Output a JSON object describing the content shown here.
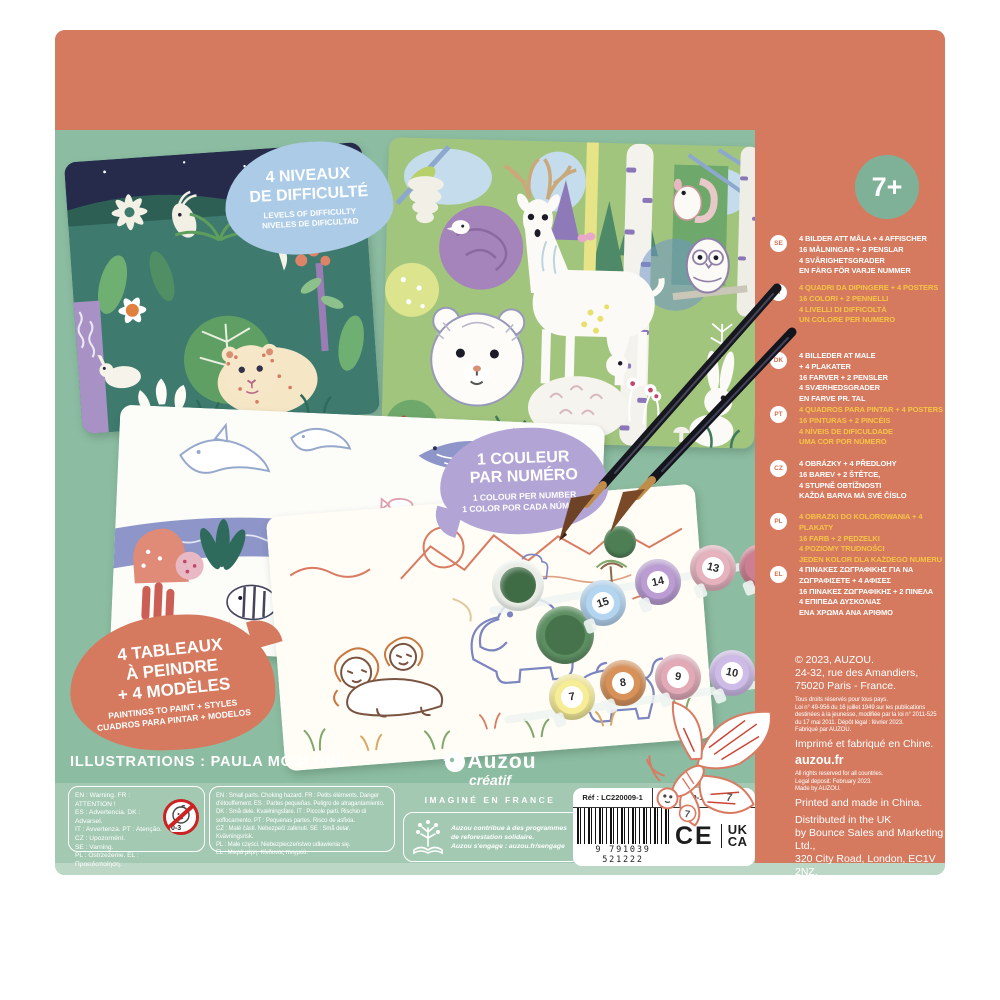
{
  "colors": {
    "coral": "#d57a5f",
    "teal_green": "#8cbca1",
    "light_green_strip": "#a3c9b2",
    "badge_blue": "#abcbe7",
    "badge_purple": "#b2a5d5",
    "accent_yellow": "#f6c445"
  },
  "product": {
    "age_badge": "7+",
    "illustrations_credit": "ILLUSTRATIONS : PAULA MCGLOIN"
  },
  "badges": {
    "difficulty": {
      "title": [
        "4 NIVEAUX",
        "DE DIFFICULTÉ"
      ],
      "sub": [
        "LEVELS OF DIFFICULTY",
        "NIVELES DE DIFICULTAD"
      ]
    },
    "colour": {
      "title": [
        "1 COULEUR",
        "PAR NUMÉRO"
      ],
      "sub": [
        "1 COLOUR PER NUMBER",
        "1 COLOR POR CADA NÚMERO"
      ]
    },
    "paintings": {
      "title": [
        "4 TABLEAUX",
        "À PEINDRE",
        "+ 4 MODÈLES"
      ],
      "sub": [
        "PAINTINGS TO PAINT + STYLES",
        "CUADROS PARA PINTAR + MODELOS"
      ]
    }
  },
  "languages": [
    {
      "code": "SE",
      "lines": [
        "4 BILDER ATT MÅLA + 4 AFFISCHER",
        "16 MÅLNINGAR + 2 PENSLAR",
        "4 SVÅRIGHETSGRADER",
        "EN FÄRG FÖR VARJE NUMMER"
      ]
    },
    {
      "code": "IT",
      "lines": [
        "4 QUADRI DA DIPINGERE + 4 POSTERS",
        "16 COLORI + 2 PENNELLI",
        "4 LIVELLI DI DIFFICOLTÀ",
        "UN COLORE PER NUMERO"
      ]
    },
    {
      "code": "DK",
      "lines": [
        "4 BILLEDER AT MALE",
        "+ 4 PLAKATER",
        "16 FARVER + 2 PENSLER",
        "4 SVÆRHEDSGRADER",
        "EN FARVE PR. TAL"
      ]
    },
    {
      "code": "PT",
      "lines": [
        "4 QUADROS PARA PINTAR + 4 POSTERS",
        "16 PINTURAS + 2 PINCÉIS",
        "4 NÍVEIS DE DIFICULDADE",
        "UMA COR POR NÚMERO"
      ]
    },
    {
      "code": "CZ",
      "lines": [
        "4 OBRÁZKY + 4 PŘEDLOHY",
        "16 BAREV + 2 ŠTĚTCE,",
        "4 STUPNĚ OBTÍŽNOSTI",
        "KAŽDÁ BARVA MÁ SVÉ ČÍSLO"
      ]
    },
    {
      "code": "PL",
      "lines": [
        "4 OBRAZKI DO KOLOROWANIA + 4 PLAKATY",
        "16 FARB + 2 PĘDZELKI",
        "4 POZIOMY TRUDNOŚCI",
        "JEDEN KOLOR DLA KAŻDEGO NUMERU"
      ]
    },
    {
      "code": "EL",
      "lines": [
        "4 ΠΙΝΑΚΕΣ ΖΩΓΡΑΦΙΚΗΣ ΓΙΑ ΝΑ",
        "ΖΩΓΡΑΦΙΣΕΤΕ + 4 ΑΦΙΣΕΣ",
        "16 ΠΙΝΑΚΕΣ ΖΩΓΡΑΦΙΚΗΣ + 2 ΠΙΝΕΛΑ",
        "4 ΕΠΙΠΕΔΑ ΔΥΣΚΟΛΙΑΣ",
        "ΕΝΑ ΧΡΩΜΑ ΑΝΑ ΑΡΙΘΜΟ"
      ]
    }
  ],
  "brand": {
    "name": "Auzou",
    "sub": "créatif",
    "tagline": "IMAGINÉ EN FRANCE"
  },
  "eco": {
    "lines": [
      "Auzou contribue à des programmes",
      "de reforestation solidaire.",
      "Auzou s'engage : auzou.fr/sengage"
    ]
  },
  "legal_fr": {
    "address_lines": [
      "© 2023, AUZOU.",
      "24-32, rue des Amandiers,",
      "75020 Paris - France."
    ],
    "small_lines": [
      "Tous droits réservés pour tous pays.",
      "Loi n° 49-956 du 16 juillet 1949 sur les publications",
      "destinées à la jeunesse, modifiée par la loi n° 2011-525",
      "du 17 mai 2011. Dépôt légal : février 2023.",
      "Fabriqué par AUZOU."
    ],
    "made_line": "Imprimé et fabriqué en Chine.",
    "website": "auzou.fr"
  },
  "legal_en": {
    "small_lines": [
      "All rights reserved for all countries.",
      "Legal deposit: February 2023.",
      "Made by AUZOU."
    ],
    "made_line": "Printed and made in China.",
    "distribution_lines": [
      "Distributed in the UK",
      "by Bounce Sales and Marketing Ltd.,",
      "320 City Road, London, EC1V 2NZ."
    ]
  },
  "codes": {
    "ref": "Réf : LC220009-1",
    "isbn": "ISBN : 979-1-0395-2122-2",
    "barcode_digits": "9 791039 521222",
    "ce": "CE",
    "ukca": [
      "UK",
      "CA"
    ]
  },
  "warnings": {
    "attention_lines": [
      "EN : Warning. FR : ATTENTION !",
      "ES : Advertencia. DK : Advarsel.",
      "IT : Avvertenza. PT : Atenção.",
      "CZ : Upozornění.",
      "SE : Varning.",
      "PL : Ostrzeżenie. EL : Προειδοποίηση."
    ],
    "small_parts_lines": [
      "EN : Small parts. Choking hazard. FR : Petits éléments. Danger",
      "d'étouffement. ES : Partes pequeñas. Peligro de atragantamiento.",
      "DK : Små dele. Kvælningsfare. IT : Piccole parti. Rischio di",
      "soffocamento. PT : Pequenas partes. Risco de asfixia.",
      "CZ : Malé části. Nebezpečí zalknutí. SE : Små delar. Kvävningsrisk.",
      "PL : Małe części. Niebezpieczeństwo udławienia się.",
      "EL : Μικρά μέρη. Κίνδυνος πνιγμού."
    ],
    "age_restriction": "0-3"
  },
  "pots": {
    "top": [
      "15",
      "14",
      "13"
    ],
    "bottom": [
      "7",
      "8",
      "9",
      "10"
    ]
  },
  "butterfly": {
    "numbers": [
      "7",
      "7"
    ]
  }
}
